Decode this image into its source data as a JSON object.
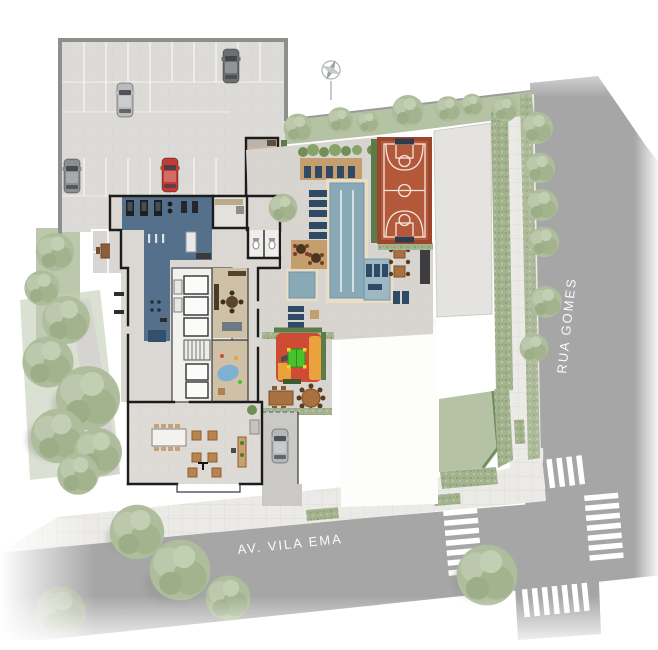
{
  "streets": {
    "avenue_label": "AV. VILA EMA",
    "cross_street_label": "RUA GOMES"
  },
  "colors": {
    "street": "#a6a6a6",
    "sidewalk": "#ebeae6",
    "crosswalk": "#ffffff",
    "parking": "#dcdbd8",
    "neighbor_concrete": "#e4e3e0",
    "white_lot": "#fdfdfc",
    "gym_floor": "#54708a",
    "pool_water": "#8aa9b6",
    "pool_shelf": "#9db8c2",
    "pool_coping": "#e9ddc6",
    "court_base": "#b4583a",
    "court_border": "#9e462d",
    "playground_red": "#d04b35",
    "playground_orange": "#eaa23c",
    "playhouse_green": "#46c32d",
    "lawn": "#b5c2a3",
    "hedge_dark": "#5d7a49",
    "wood_deck": "#c49f6d",
    "wood_floor": "#cfc1a5",
    "tile_floor": "#dbd8d4",
    "wall": "#1c1c1c",
    "car_dark_gray": "#6d7073",
    "car_silver": "#b9bbbd",
    "car_gray": "#8b8e90",
    "car_red": "#c23b35",
    "label_text": "#ffffff"
  }
}
